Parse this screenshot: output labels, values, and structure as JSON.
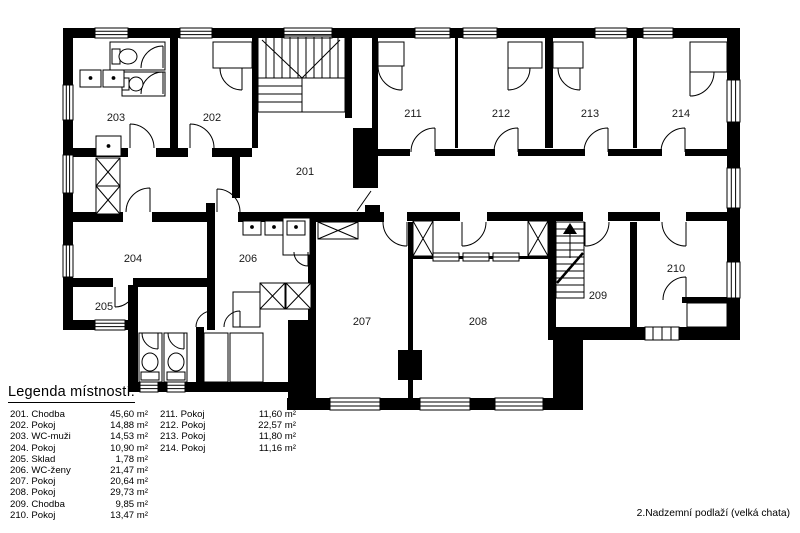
{
  "caption": "2.Nadzemní podlaží (velká chata)",
  "colors": {
    "wall": "#000000",
    "background": "#ffffff"
  },
  "rooms": [
    {
      "number": "201"
    },
    {
      "number": "202"
    },
    {
      "number": "203"
    },
    {
      "number": "204"
    },
    {
      "number": "205"
    },
    {
      "number": "206"
    },
    {
      "number": "207"
    },
    {
      "number": "208"
    },
    {
      "number": "209"
    },
    {
      "number": "210"
    },
    {
      "number": "211"
    },
    {
      "number": "212"
    },
    {
      "number": "213"
    },
    {
      "number": "214"
    }
  ],
  "legend": {
    "heading": "Legenda místností:",
    "col1": [
      {
        "label": "201. Chodba",
        "area": "45,60 m²"
      },
      {
        "label": "202. Pokoj",
        "area": "14,88 m²"
      },
      {
        "label": "203. WC-muži",
        "area": "14,53 m²"
      },
      {
        "label": "204. Pokoj",
        "area": "10,90 m²"
      },
      {
        "label": "205. Sklad",
        "area": "1,78 m²"
      },
      {
        "label": "206. WC-ženy",
        "area": "21,47 m²"
      },
      {
        "label": "207. Pokoj",
        "area": "20,64 m²"
      },
      {
        "label": "208. Pokoj",
        "area": "29,73 m²"
      },
      {
        "label": "209. Chodba",
        "area": "9,85 m²"
      },
      {
        "label": "210. Pokoj",
        "area": "13,47 m²"
      }
    ],
    "col2": [
      {
        "label": "211. Pokoj",
        "area": "11,60 m²"
      },
      {
        "label": "212. Pokoj",
        "area": "22,57 m²"
      },
      {
        "label": "213. Pokoj",
        "area": "11,80 m²"
      },
      {
        "label": "214. Pokoj",
        "area": "11,16 m²"
      }
    ]
  }
}
